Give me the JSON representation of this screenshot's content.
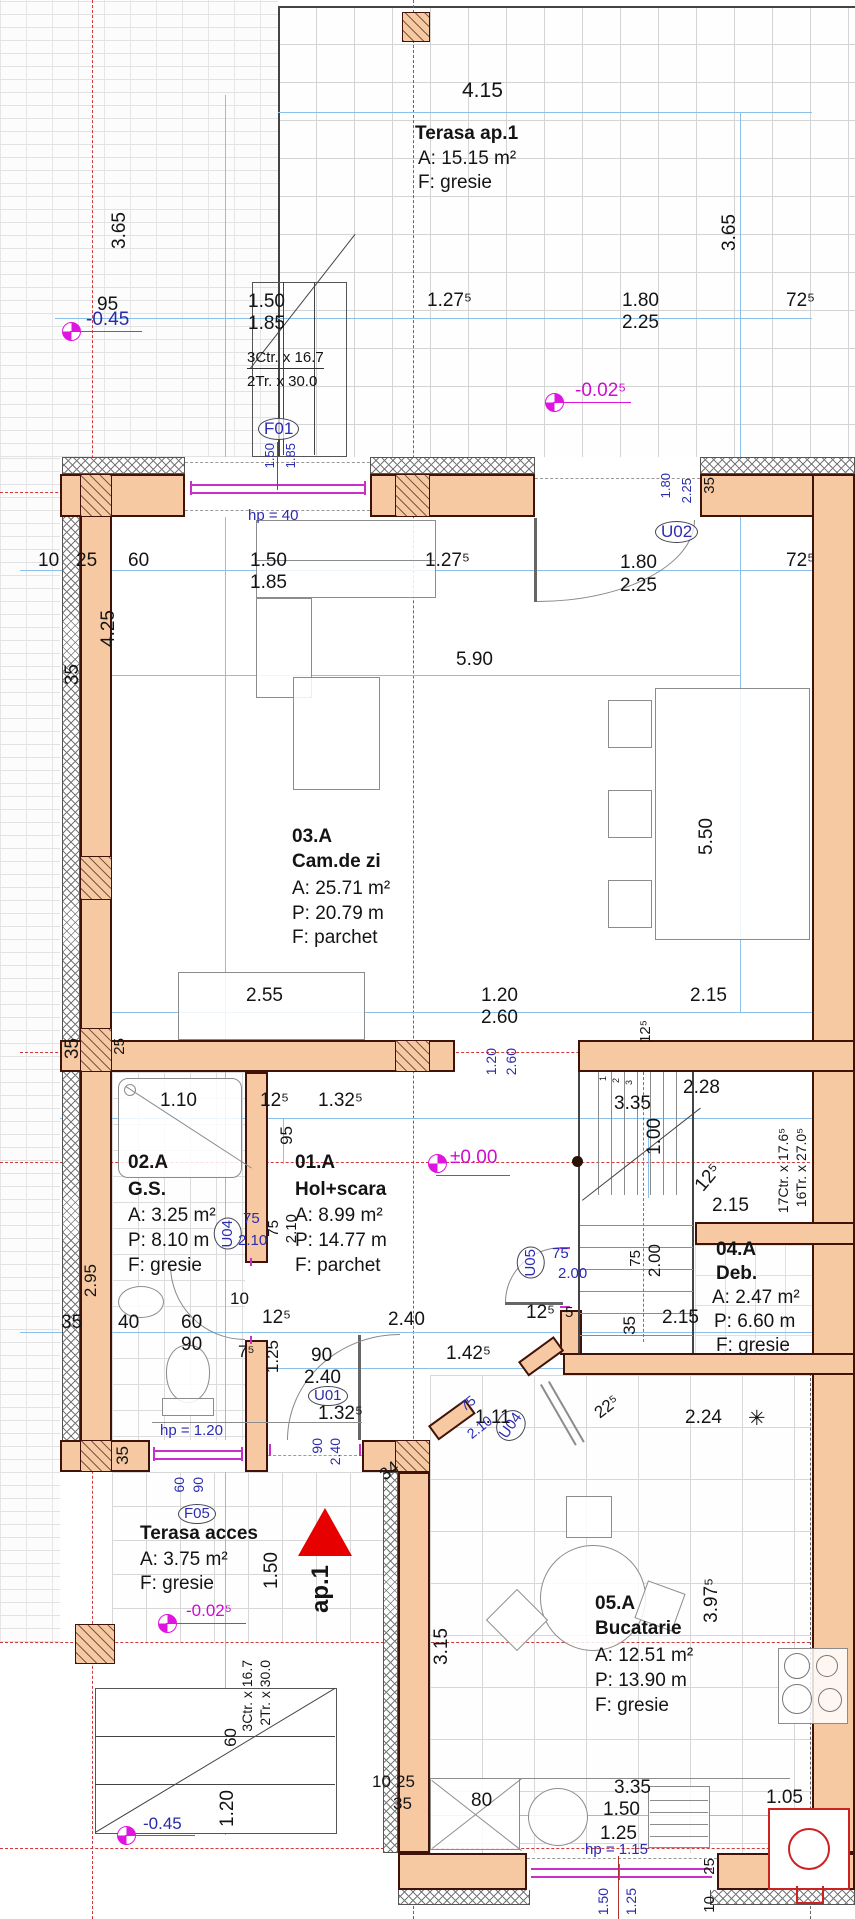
{
  "drawing": {
    "rooms": {
      "terasa1": {
        "name": "Terasa ap.1",
        "area": "A: 15.15 m²",
        "floor": "F: gresie"
      },
      "camdezi": {
        "num": "03.A",
        "name": "Cam.de zi",
        "area": "A: 25.71 m²",
        "perimeter": "P: 20.79 m",
        "floor": "F: parchet"
      },
      "gs": {
        "num": "02.A",
        "name": "G.S.",
        "area": "A: 3.25 m²",
        "perimeter": "P: 8.10 m",
        "floor": "F: gresie"
      },
      "hol": {
        "num": "01.A",
        "name": "Hol+scara",
        "area": "A: 8.99 m²",
        "perimeter": "P: 14.77 m",
        "floor": "F: parchet"
      },
      "deb": {
        "num": "04.A",
        "name": "Deb.",
        "area": "A: 2.47 m²",
        "perimeter": "P: 6.60 m",
        "floor": "F: gresie"
      },
      "bucatarie": {
        "num": "05.A",
        "name": "Bucatarie",
        "area": "A: 12.51 m²",
        "perimeter": "P: 13.90 m",
        "floor": "F: gresie"
      },
      "terasa_acces": {
        "name": "Terasa acces",
        "area": "A: 3.75 m²",
        "floor": "F: gresie"
      }
    },
    "levels": {
      "minus045": "-0.45",
      "minus0025": "-0.02⁵",
      "zero": "±0.00"
    },
    "openings": {
      "f01": "F01",
      "u01": "U01",
      "u02": "U02",
      "u04": "U04",
      "u05": "U05",
      "f05": "F05"
    },
    "sills": {
      "f01": "hp =  40",
      "f05": "hp = 1.20",
      "kitchen": "hp = 1.15"
    },
    "stairs": {
      "ext1": "3Ctr. x 16.7",
      "ext2": "2Tr. x 30.0",
      "main1": "17Ctr. x 17.6⁵",
      "main2": "16Tr. x 27.0⁵",
      "n1": "1",
      "n2": "2",
      "n3": "3"
    },
    "entrance": {
      "label": "ap.1"
    },
    "dims": {
      "d4_15": "4.15",
      "d3_65": "3.65",
      "d95": "95",
      "d1_50": "1.50",
      "d1_85": "1.85",
      "d1_27_5": "1.27⁵",
      "d1_80": "1.80",
      "d2_25": "2.25",
      "d72_5": "72⁵",
      "d10": "10",
      "d25": "25",
      "d60": "60",
      "d5_90": "5.90",
      "d4_25": "4.25",
      "d35": "35",
      "d5_50": "5.50",
      "d2_55": "2.55",
      "d1_20": "1.20",
      "d2_60": "2.60",
      "d2_15": "2.15",
      "d12_5": "12⁵",
      "d1_10": "1.10",
      "d1_32_5": "1.32⁵",
      "d2_28": "2.28",
      "d3_35": "3.35",
      "d1_00": "1.00",
      "d75": "75",
      "d2_10": "2.10",
      "d2_00": "2.00",
      "d5": "5",
      "d40": "40",
      "d90": "90",
      "d2_40": "2.40",
      "d7_5": "7⁵",
      "d1_25": "1.25",
      "d1_42_5": "1.42⁵",
      "d1_11": "1.11",
      "d22_5": "22⁵",
      "d2_24": "2.24",
      "d34": "34",
      "d3_15": "3.15",
      "d3_97_5": "3.97⁵",
      "d80": "80",
      "d1_05": "1.05",
      "d2_95": "2.95",
      "star": "✳"
    }
  }
}
